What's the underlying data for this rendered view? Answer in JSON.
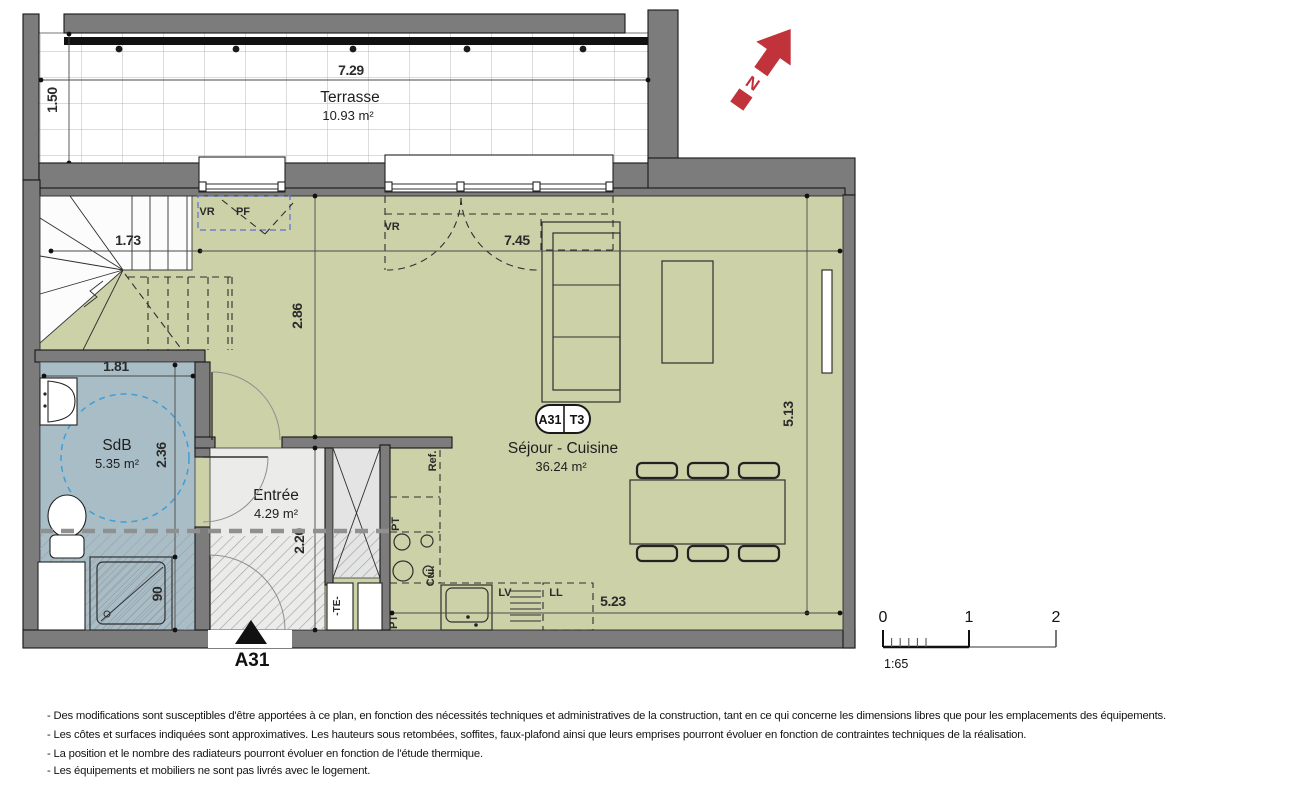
{
  "colors": {
    "wall_gray": "#7c7c7c",
    "floor_green": "#ccd1a8",
    "floor_blue": "#a9bdc7",
    "floor_entry": "#ebebe9",
    "north_red": "#c1333a",
    "dash_blue": "#5b6fd0",
    "circle_blue": "#3f9ed6"
  },
  "north": {
    "label": "N"
  },
  "rooms": {
    "terrasse": {
      "name": "Terrasse",
      "area": "10.93 m²"
    },
    "sejour": {
      "name": "Séjour - Cuisine",
      "area": "36.24 m²"
    },
    "sdb": {
      "name": "SdB",
      "area": "5.35 m²"
    },
    "entree": {
      "name": "Entrée",
      "area": "4.29 m²"
    }
  },
  "badge": {
    "unit": "A31",
    "type": "T3"
  },
  "entrance": {
    "label": "A31"
  },
  "dimensions": {
    "terrace_width": "7.29",
    "terrace_depth": "1.50",
    "stairs_width": "1.73",
    "sejour_width": "7.45",
    "sejour_depth_left": "2.86",
    "sejour_depth_right": "5.13",
    "kitchen_run": "5.23",
    "sdb_width": "1.81",
    "sdb_depth": "2.36",
    "shower_width": "90",
    "entree_depth": "2.20"
  },
  "fixtures": {
    "vr_small": "VR",
    "pf": "PF",
    "vr_large": "VR",
    "fridge": "Ref.",
    "worktop_upper": "PT",
    "worktop_lower": "PT",
    "hob": "Cui.",
    "dishwasher": "LV",
    "washer": "LL",
    "electrical": "-TE-"
  },
  "scalebar": {
    "t0": "0",
    "t1": "1",
    "t2": "2",
    "ratio": "1:65"
  },
  "footer": {
    "lines": [
      "- Des modifications sont susceptibles d'être apportées à ce plan, en fonction des nécessités techniques et administratives de la construction, tant en ce qui concerne les dimensions libres que pour les emplacements des équipements.",
      "- Les côtes et surfaces indiquées sont approximatives. Les hauteurs sous retombées, soffites, faux-plafond ainsi que leurs emprises pourront évoluer en fonction de contraintes techniques de la réalisation.",
      "- La position et le nombre des radiateurs pourront évoluer en fonction de l'étude thermique.",
      "- Les équipements et mobiliers ne sont pas livrés avec le logement."
    ]
  }
}
